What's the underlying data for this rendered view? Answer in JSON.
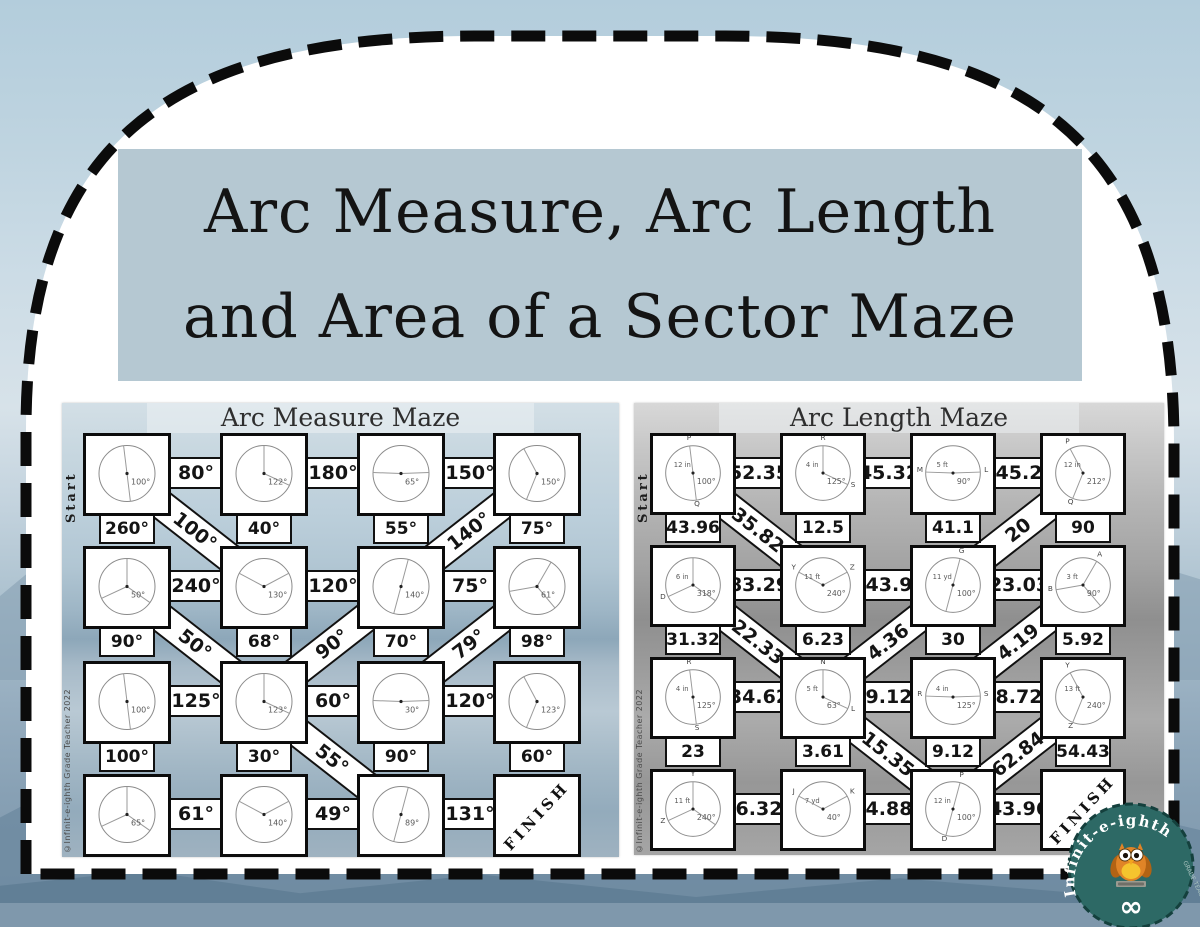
{
  "page": {
    "title_line1": "Arc Measure, Arc Length",
    "title_line2": "and Area of a Sector Maze"
  },
  "logo": {
    "brand": "Infinit-e-ighth",
    "sub": "GRADE TEACHER",
    "infinity": "∞",
    "owl_icon": "owl-icon",
    "circle_color": "#2d6965"
  },
  "colors": {
    "title_box_bg": "#b5c8d2",
    "frame_dash": "#0b0b0b",
    "sky": "#b7cfdd"
  },
  "mazes": [
    {
      "id": "arc-measure",
      "title": "Arc Measure Maze",
      "start": "Start",
      "finish": "FINISH",
      "copyright": "©Infinit-e-ighth Grade Teacher 2022",
      "h": [
        [
          "80°",
          "180°",
          "150°"
        ],
        [
          "240°",
          "120°",
          "75°"
        ],
        [
          "125°",
          "60°",
          "120°"
        ],
        [
          "61°",
          "49°",
          "131°"
        ]
      ],
      "v": [
        [
          "260°",
          "40°",
          "55°",
          "75°"
        ],
        [
          "90°",
          "68°",
          "70°",
          "98°"
        ],
        [
          "100°",
          "30°",
          "90°",
          "60°"
        ]
      ],
      "d": [
        {
          "gap": 0,
          "col": 0,
          "dir": "down",
          "value": "100°"
        },
        {
          "gap": 0,
          "col": 2,
          "dir": "up",
          "value": "140°"
        },
        {
          "gap": 1,
          "col": 0,
          "dir": "down",
          "value": "50°"
        },
        {
          "gap": 1,
          "col": 1,
          "dir": "up",
          "value": "90°"
        },
        {
          "gap": 1,
          "col": 2,
          "dir": "up",
          "value": "79°"
        },
        {
          "gap": 2,
          "col": 1,
          "dir": "down",
          "value": "55°"
        }
      ],
      "circles": [
        [
          {
            "label": "100°"
          },
          {
            "label": "122°"
          },
          {
            "label": "65°"
          },
          {
            "label": "150°"
          }
        ],
        [
          {
            "label": "50°"
          },
          {
            "label": "130°"
          },
          {
            "label": "140°"
          },
          {
            "label": "61°"
          }
        ],
        [
          {
            "label": "100°"
          },
          {
            "label": "123°"
          },
          {
            "label": "30°"
          },
          {
            "label": "123°"
          }
        ],
        [
          {
            "label": "65°"
          },
          {
            "label": "140°"
          },
          {
            "label": "89°"
          },
          {
            "finish": true
          }
        ]
      ]
    },
    {
      "id": "arc-length",
      "title": "Arc Length Maze",
      "start": "Start",
      "finish": "FINISH",
      "copyright": "©Infinit-e-ighth Grade Teacher 2022",
      "h": [
        [
          "52.35",
          "45.32",
          "45.2"
        ],
        [
          "83.29",
          "43.9",
          "23.03"
        ],
        [
          "34.62",
          "9.12",
          "8.72"
        ],
        [
          "6.32",
          "4.88",
          "43.96"
        ]
      ],
      "v": [
        [
          "43.96",
          "12.5",
          "41.1",
          "90"
        ],
        [
          "31.32",
          "6.23",
          "30",
          "5.92"
        ],
        [
          "23",
          "3.61",
          "9.12",
          "54.43"
        ]
      ],
      "d": [
        {
          "gap": 0,
          "col": 0,
          "dir": "down",
          "value": "35.82"
        },
        {
          "gap": 0,
          "col": 2,
          "dir": "up",
          "value": "20"
        },
        {
          "gap": 1,
          "col": 0,
          "dir": "down",
          "value": "22.33"
        },
        {
          "gap": 1,
          "col": 1,
          "dir": "up",
          "value": "4.36"
        },
        {
          "gap": 1,
          "col": 2,
          "dir": "up",
          "value": "4.19"
        },
        {
          "gap": 2,
          "col": 1,
          "dir": "down",
          "value": "15.35"
        },
        {
          "gap": 2,
          "col": 2,
          "dir": "up",
          "value": "62.84"
        }
      ],
      "circles": [
        [
          {
            "label": "100°",
            "sub": "12 in",
            "p1": "P",
            "p2": "Q"
          },
          {
            "label": "125°",
            "sub": "4 in",
            "p1": "R",
            "p2": "S"
          },
          {
            "label": "90°",
            "sub": "5 ft",
            "p1": "M",
            "p2": "L"
          },
          {
            "label": "212°",
            "sub": "12 in",
            "p1": "P",
            "p2": "Q"
          }
        ],
        [
          {
            "label": "318°",
            "sub": "6 in",
            "p2": "D"
          },
          {
            "label": "240°",
            "sub": "11 ft",
            "p1": "Y",
            "p2": "Z"
          },
          {
            "label": "100°",
            "sub": "11 yd",
            "p1": "G"
          },
          {
            "label": "90°",
            "sub": "3 ft",
            "p1": "A",
            "p2": "B"
          }
        ],
        [
          {
            "label": "125°",
            "sub": "4 in",
            "p1": "R",
            "p2": "S"
          },
          {
            "label": "63°",
            "sub": "5 ft",
            "p1": "N",
            "p2": "L"
          },
          {
            "label": "125°",
            "sub": "4 in",
            "p1": "R",
            "p2": "S"
          },
          {
            "label": "240°",
            "sub": "13 ft",
            "p1": "Y",
            "p2": "Z"
          }
        ],
        [
          {
            "label": "240°",
            "sub": "11 ft",
            "p1": "Y",
            "p2": "Z"
          },
          {
            "label": "40°",
            "sub": "7 yd",
            "p1": "J",
            "p2": "K"
          },
          {
            "label": "100°",
            "sub": "12 in",
            "p1": "P",
            "p2": "D"
          },
          {
            "finish": true
          }
        ]
      ]
    }
  ]
}
